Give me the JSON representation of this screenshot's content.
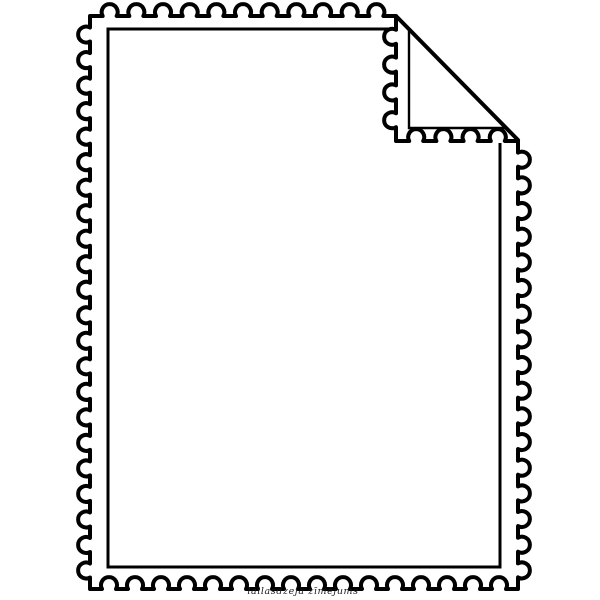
{
  "illustration": {
    "subject": "blank postage stamp outline with folded top-right corner",
    "signature": "lailasdzeja zīmējums",
    "colors": {
      "line": "#000000",
      "background": "#ffffff",
      "signature": "#1a1a1a"
    }
  }
}
